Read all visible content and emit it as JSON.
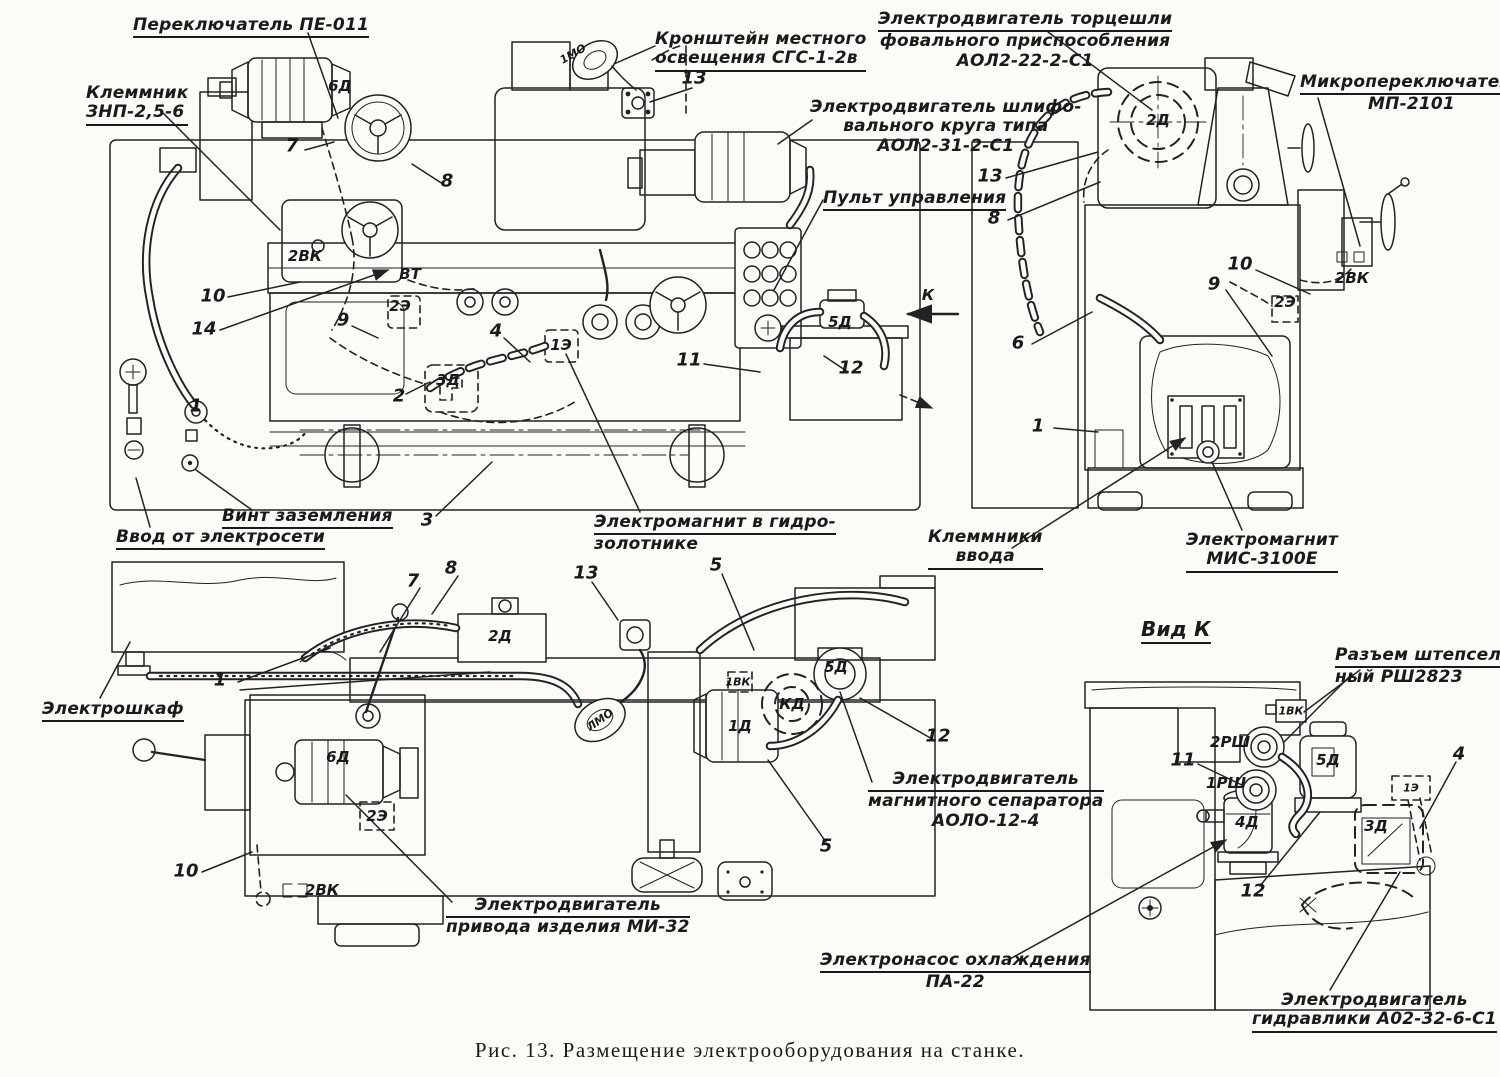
{
  "figure": {
    "caption": "Рис. 13. Размещение электрооборудования на станке."
  },
  "callouts": [
    {
      "id": "switch-pe011",
      "lines": [
        "Переключатель ПЕ-011"
      ],
      "x": 133,
      "y": 16,
      "u": "all"
    },
    {
      "id": "terminal-znp",
      "lines": [
        "Клеммник",
        "ЗНП-2,5-6"
      ],
      "x": 86,
      "y": 84,
      "u": "all"
    },
    {
      "id": "light-bracket",
      "lines": [
        "Кронштейн местного",
        "освещения СГС-1-2в"
      ],
      "x": 655,
      "y": 30,
      "u": "all"
    },
    {
      "id": "motor-face-grinding",
      "lines": [
        "Электродвигатель торцешли",
        "фовального приспособления",
        "АОЛ2-22-2-С1"
      ],
      "x": 878,
      "y": 10,
      "u": "first",
      "align": "center"
    },
    {
      "id": "microswitch",
      "lines": [
        "Микропереключатель",
        "МП-2101"
      ],
      "x": 1300,
      "y": 73,
      "u": "first",
      "align": "center"
    },
    {
      "id": "motor-grinding-wheel",
      "lines": [
        "Электродвигатель шлифо-",
        "вального круга типа",
        "АОЛ2-31-2-С1"
      ],
      "x": 810,
      "y": 98,
      "align": "center"
    },
    {
      "id": "control-panel",
      "lines": [
        "Пульт управления"
      ],
      "x": 823,
      "y": 189,
      "u": "all"
    },
    {
      "id": "ground-screw",
      "lines": [
        "Винт заземления"
      ],
      "x": 222,
      "y": 507,
      "u": "all"
    },
    {
      "id": "mains-input",
      "lines": [
        "Ввод от электросети"
      ],
      "x": 116,
      "y": 528,
      "u": "all"
    },
    {
      "id": "electromagnet-hydrovalve",
      "lines": [
        "Электромагнит в гидро-",
        "золотнике"
      ],
      "x": 594,
      "y": 513,
      "u": "first"
    },
    {
      "id": "input-terminals",
      "lines": [
        "Клеммники",
        "ввода"
      ],
      "x": 928,
      "y": 528,
      "u": "all",
      "align": "center"
    },
    {
      "id": "electromagnet-mis",
      "lines": [
        "Электромагнит",
        "МИС-3100Е"
      ],
      "x": 1186,
      "y": 531,
      "u": "all",
      "align": "center"
    },
    {
      "id": "electric-cabinet",
      "lines": [
        "Электрошкаф"
      ],
      "x": 42,
      "y": 700,
      "u": "all"
    },
    {
      "id": "motor-separator",
      "lines": [
        "Электродвигатель",
        "магнитного сепаратора",
        "АОЛО-12-4"
      ],
      "x": 868,
      "y": 770,
      "u": "first",
      "align": "center"
    },
    {
      "id": "motor-workpiece-drive",
      "lines": [
        "Электродвигатель",
        "привода изделия МИ-32"
      ],
      "x": 446,
      "y": 896,
      "u": "first",
      "align": "center"
    },
    {
      "id": "coolant-pump",
      "lines": [
        "Электронасос охлаждения",
        "ПА-22"
      ],
      "x": 820,
      "y": 951,
      "u": "first",
      "align": "center"
    },
    {
      "id": "view-k-title",
      "lines": [
        "Вид К"
      ],
      "x": 1141,
      "y": 618,
      "u": "all",
      "big": true
    },
    {
      "id": "plug-connector",
      "lines": [
        "Разъем штепсель-",
        "ный РШ2823"
      ],
      "x": 1335,
      "y": 646,
      "u": "first"
    },
    {
      "id": "motor-hydraulics",
      "lines": [
        "Электродвигатель",
        "гидравлики А02-32-6-С1"
      ],
      "x": 1252,
      "y": 991,
      "u": "all",
      "align": "center"
    }
  ],
  "numbers": [
    {
      "n": "7",
      "x": 292,
      "y": 146
    },
    {
      "n": "8",
      "x": 447,
      "y": 181
    },
    {
      "n": "10",
      "x": 213,
      "y": 296
    },
    {
      "n": "14",
      "x": 204,
      "y": 329
    },
    {
      "n": "9",
      "x": 343,
      "y": 320
    },
    {
      "n": "2",
      "x": 399,
      "y": 396
    },
    {
      "n": "4",
      "x": 496,
      "y": 331
    },
    {
      "n": "13",
      "x": 694,
      "y": 78
    },
    {
      "n": "11",
      "x": 689,
      "y": 360
    },
    {
      "n": "12",
      "x": 851,
      "y": 368
    },
    {
      "n": "3",
      "x": 427,
      "y": 520
    },
    {
      "n": "1",
      "x": 196,
      "y": 406
    },
    {
      "n": "13",
      "x": 990,
      "y": 176
    },
    {
      "n": "8",
      "x": 994,
      "y": 218
    },
    {
      "n": "10",
      "x": 1240,
      "y": 264
    },
    {
      "n": "9",
      "x": 1214,
      "y": 284
    },
    {
      "n": "6",
      "x": 1018,
      "y": 343
    },
    {
      "n": "1",
      "x": 1038,
      "y": 426
    },
    {
      "n": "1",
      "x": 220,
      "y": 680
    },
    {
      "n": "7",
      "x": 413,
      "y": 581
    },
    {
      "n": "8",
      "x": 451,
      "y": 568
    },
    {
      "n": "13",
      "x": 586,
      "y": 573
    },
    {
      "n": "5",
      "x": 716,
      "y": 565
    },
    {
      "n": "10",
      "x": 186,
      "y": 871
    },
    {
      "n": "12",
      "x": 938,
      "y": 736
    },
    {
      "n": "5",
      "x": 826,
      "y": 846
    },
    {
      "n": "11",
      "x": 1183,
      "y": 760
    },
    {
      "n": "12",
      "x": 1253,
      "y": 891
    },
    {
      "n": "4",
      "x": 1459,
      "y": 754
    }
  ],
  "codes": [
    {
      "t": "6Д",
      "x": 340,
      "y": 86
    },
    {
      "t": "2ВК",
      "x": 305,
      "y": 256
    },
    {
      "t": "ВТ",
      "x": 410,
      "y": 274
    },
    {
      "t": "2Э",
      "x": 400,
      "y": 306
    },
    {
      "t": "3Д",
      "x": 448,
      "y": 380
    },
    {
      "t": "1Э",
      "x": 561,
      "y": 345
    },
    {
      "t": "5Д",
      "x": 840,
      "y": 322
    },
    {
      "t": "1МО",
      "x": 573,
      "y": 54,
      "r": -30,
      "small": true
    },
    {
      "t": "К",
      "x": 928,
      "y": 295
    },
    {
      "t": "2Д",
      "x": 1158,
      "y": 120
    },
    {
      "t": "2Э",
      "x": 1285,
      "y": 302
    },
    {
      "t": "2ВК",
      "x": 1352,
      "y": 278
    },
    {
      "t": "2Д",
      "x": 500,
      "y": 636
    },
    {
      "t": "6Д",
      "x": 338,
      "y": 757
    },
    {
      "t": "2Э",
      "x": 377,
      "y": 816
    },
    {
      "t": "2ВК",
      "x": 322,
      "y": 890
    },
    {
      "t": "ЛМО",
      "x": 600,
      "y": 720,
      "r": -35,
      "small": true
    },
    {
      "t": "1Д",
      "x": 740,
      "y": 726
    },
    {
      "t": "КД",
      "x": 792,
      "y": 704
    },
    {
      "t": "5Д",
      "x": 836,
      "y": 667
    },
    {
      "t": "1ВК",
      "x": 738,
      "y": 682,
      "small": true
    },
    {
      "t": "1ВК",
      "x": 1291,
      "y": 711,
      "small": true
    },
    {
      "t": "2РШ",
      "x": 1230,
      "y": 742
    },
    {
      "t": "1РШ",
      "x": 1226,
      "y": 783
    },
    {
      "t": "4Д",
      "x": 1247,
      "y": 822
    },
    {
      "t": "5Д",
      "x": 1328,
      "y": 760
    },
    {
      "t": "1Э",
      "x": 1411,
      "y": 788,
      "small": true
    },
    {
      "t": "3Д",
      "x": 1376,
      "y": 826
    }
  ]
}
